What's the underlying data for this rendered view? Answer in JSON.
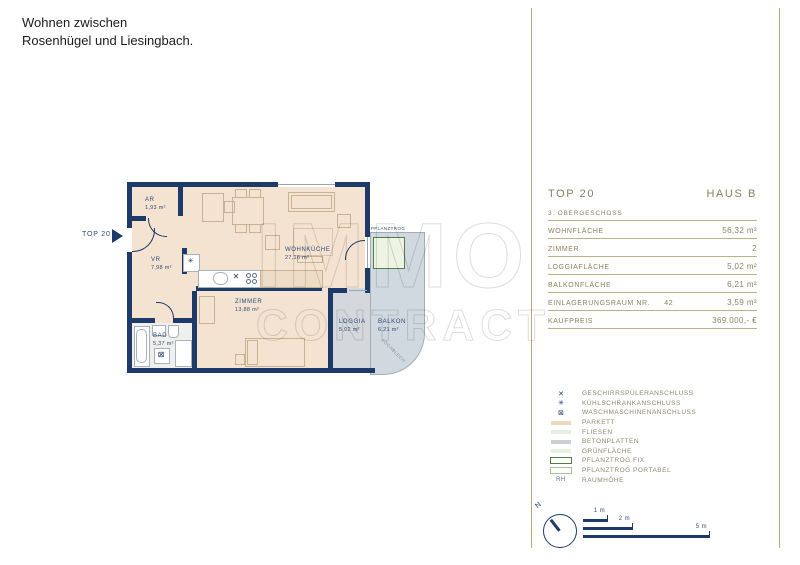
{
  "header": {
    "title_line1": "Wohnen zwischen",
    "title_line2": "Rosenhügel und Liesingbach."
  },
  "watermark": {
    "line1": "IMMO",
    "line2": "CONTRACT"
  },
  "plan": {
    "unit_label": "TOP 20",
    "rooms": {
      "ar": {
        "name": "AR",
        "area": "1,93 m²"
      },
      "vr": {
        "name": "VR",
        "area": "7,98 m²"
      },
      "wohnkueche": {
        "name": "WOHNKÜCHE",
        "area": "27,16 m²"
      },
      "zimmer": {
        "name": "ZIMMER",
        "area": "13,88 m²"
      },
      "bad": {
        "name": "BAD",
        "area": "5,37 m²"
      },
      "loggia": {
        "name": "LOGGIA",
        "area": "5,02 m²"
      },
      "balkon": {
        "name": "BALKON",
        "area": "6,21 m²"
      }
    },
    "annotations": {
      "pflanztrog": "PFLANZTROG",
      "lochblech": "LOCHBLECH"
    }
  },
  "info_panel": {
    "unit": "TOP 20",
    "building": "HAUS B",
    "floor": "3. OBERGESCHOSS",
    "rows": [
      {
        "label": "WOHNFLÄCHE",
        "value": "56,32 m²"
      },
      {
        "label": "ZIMMER",
        "value": "2"
      },
      {
        "label": "LOGGIAFLÄCHE",
        "value": "5,02 m²"
      },
      {
        "label": "BALKONFLÄCHE",
        "value": "6,21 m²"
      },
      {
        "label": "EINLAGERUNGSRAUM NR.",
        "label_extra": "42",
        "value": "3,59 m²"
      },
      {
        "label": "KAUFPREIS",
        "value": "369.000,- €"
      }
    ]
  },
  "legend": {
    "items": [
      {
        "glyph": "✕",
        "icon": "dishwasher-connection-icon",
        "label": "GESCHIRRSPÜLERANSCHLUSS"
      },
      {
        "glyph": "✳",
        "icon": "fridge-connection-icon",
        "label": "KÜHLSCHRANKANSCHLUSS"
      },
      {
        "glyph": "⊠",
        "icon": "washing-machine-connection-icon",
        "label": "WASCHMASCHINENANSCHLUSS"
      },
      {
        "swatch": "#eed9bd",
        "icon": "parquet-swatch",
        "label": "PARKETT"
      },
      {
        "swatch": "#ebebe6",
        "icon": "tiles-swatch",
        "label": "FLIESEN"
      },
      {
        "swatch": "#cbd0d4",
        "icon": "concrete-slabs-swatch",
        "label": "BETONPLATTEN"
      },
      {
        "swatch": "#e9f0df",
        "icon": "green-area-swatch",
        "label": "GRÜNFLÄCHE"
      },
      {
        "outline": "#567c4d",
        "icon": "planter-fixed-swatch",
        "label": "PFLANZTROG FIX"
      },
      {
        "outline": "#a9c29b",
        "icon": "planter-portable-swatch",
        "label": "PFLANZTROG PORTABEL"
      },
      {
        "text": "RH",
        "icon": "room-height-abbr",
        "label": "RAUMHÖHE"
      }
    ]
  },
  "scale": {
    "north": "N",
    "bars": [
      {
        "label": "1 m",
        "width": 25
      },
      {
        "label": "2 m",
        "width": 50
      },
      {
        "label": "5 m",
        "width": 127
      }
    ]
  },
  "colors": {
    "navy": "#1d3a69",
    "gold_line": "#b9aa78",
    "gold_text": "#8e8160",
    "parkett": "#f5e3d1",
    "fliesen": "#efefeb",
    "beton": "#d4d8dc",
    "balkon": "#d0d8e0",
    "gruen_fill": "#edf4e3",
    "gruen_border": "#567c4d"
  }
}
